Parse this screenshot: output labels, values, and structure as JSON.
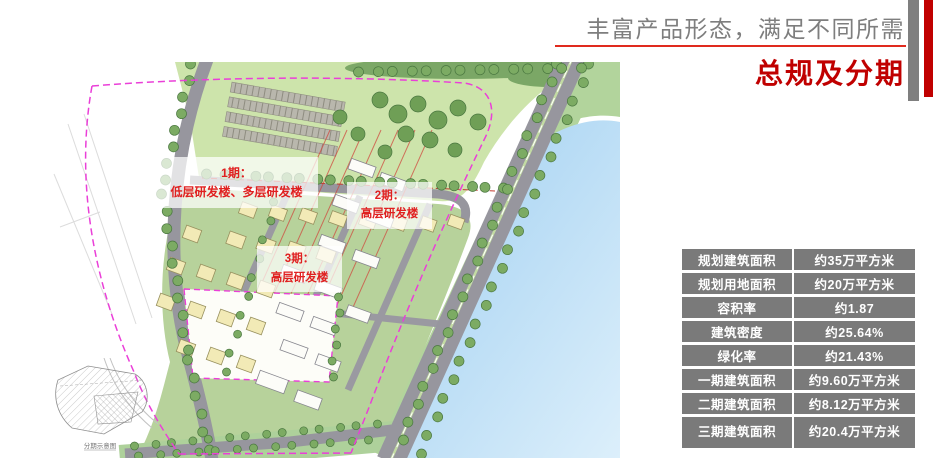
{
  "header": {
    "subtitle": "丰富产品形态，满足不同所需",
    "title": "总规及分期"
  },
  "map": {
    "phase_labels": [
      {
        "line1": "1期：",
        "line2": "低层研发楼、多层研发楼"
      },
      {
        "line1": "2期：",
        "line2": "高层研发楼"
      },
      {
        "line1": "3期：",
        "line2": "高层研发楼"
      }
    ],
    "inset_caption": "分期示意图"
  },
  "table": {
    "rows": [
      {
        "label": "规划建筑面积",
        "value": "约35万平方米"
      },
      {
        "label": "规划用地面积",
        "value": "约20万平方米"
      },
      {
        "label": "容积率",
        "value": "约1.87"
      },
      {
        "label": "建筑密度",
        "value": "约25.64%"
      },
      {
        "label": "绿化率",
        "value": "约21.43%"
      },
      {
        "label": "一期建筑面积",
        "value": "约9.60万平方米"
      },
      {
        "label": "二期建筑面积",
        "value": "约8.12万平方米"
      },
      {
        "label": "三期建筑面积",
        "value": "约20.4万平方米"
      }
    ]
  },
  "colors": {
    "accent_red": "#C00000",
    "underline_red": "#E02A1E",
    "bar_gray": "#7F7F7F",
    "label_red": "#E02020",
    "table_cell_gray": "#7A7A7A",
    "water_blue": "#A8D2F0",
    "site_green": "#B7D29B",
    "boundary_pink": "#EA3FD8"
  }
}
